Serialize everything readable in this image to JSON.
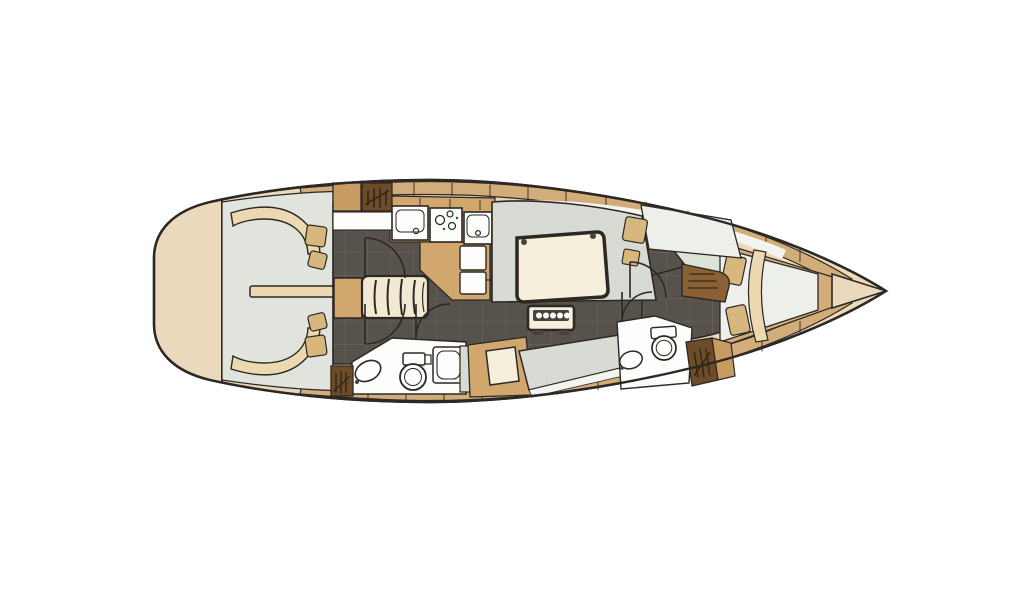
{
  "colors": {
    "background": "#ffffff",
    "line": "#2c2824",
    "deck_beige": "#ead9bc",
    "deck_tan": "#d2ad7a",
    "cockpit_floor": "#e0e4dc",
    "bench_cream": "#ecd9b2",
    "pad_tan": "#d8b77e",
    "saloon_floor": "#57524c",
    "grid_line": "#6b655e",
    "settee_gray": "#d8dad4",
    "fixture_white": "#fdfdfc",
    "stripe_white": "#f3f3ef",
    "table_cream": "#f5efdc",
    "table_border": "#46433d",
    "counter_tan": "#d2a76e",
    "wood_mid": "#c79c63",
    "cabinet_brown": "#8a6134",
    "cabinet_dark": "#6f4c28",
    "glyph_dark": "#33261a",
    "bed_white": "#edefeb",
    "cabin_floor": "#dde2d7",
    "steps_cream": "#f1e9d2"
  },
  "diagram": {
    "kind": "sailing-yacht-interior-floor-plan",
    "orientation": "bow-right-stern-left",
    "regions": [
      "swim-platform",
      "cockpit",
      "companionway",
      "galley",
      "saloon",
      "navigation-station",
      "aft-head",
      "forward-head",
      "forward-cabin",
      "anchor-locker"
    ],
    "fixtures": [
      "cockpit-bench-port",
      "cockpit-bench-starboard",
      "helm-seat-pads",
      "cockpit-table",
      "companionway-steps",
      "galley-sink",
      "galley-stove",
      "galley-refrigerator",
      "galley-lockers",
      "hanging-locker",
      "saloon-settee",
      "saloon-table",
      "bottle-rack",
      "chart-table",
      "nav-seat",
      "port-settee",
      "toilet",
      "washbasin",
      "shower",
      "wardrobe",
      "chest-of-drawers",
      "v-berth-bed",
      "upper-berth",
      "pillows",
      "door-swing-arcs",
      "deck-plank-seams",
      "bow-anchor-locker"
    ]
  }
}
